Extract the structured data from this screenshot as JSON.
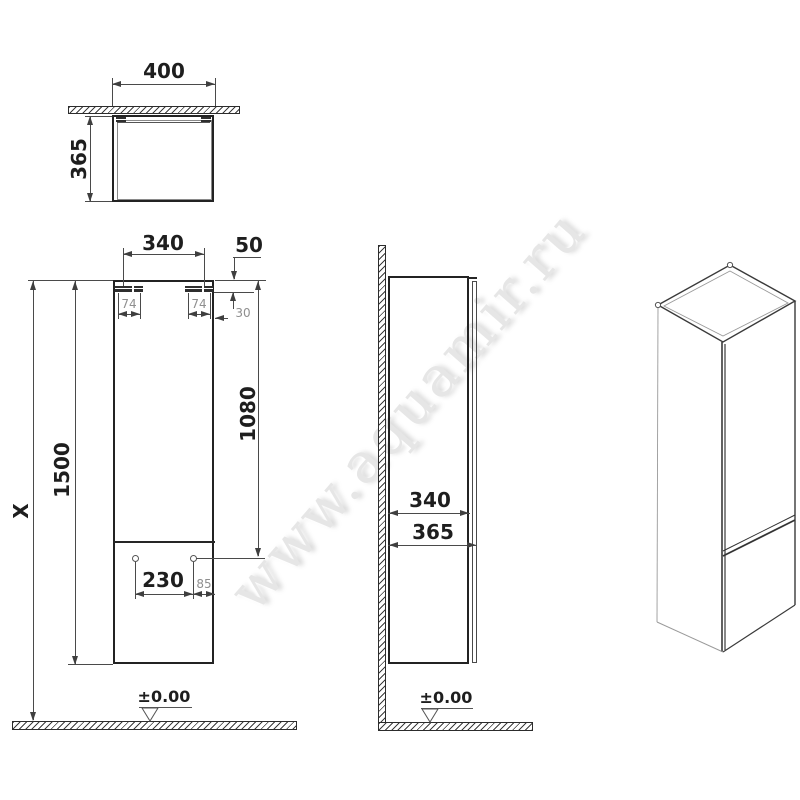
{
  "watermark": "www.aquamir.ru",
  "top_view": {
    "width": "400",
    "depth": "365"
  },
  "front_view": {
    "hanger_span": "340",
    "top_gap": "50",
    "hanger_width_left": "74",
    "hanger_width_right": "74",
    "hanger_offset": "30",
    "holes_height": "1080",
    "cabinet_height": "1500",
    "total_height": "X",
    "holes_span": "230",
    "hole_edge": "85",
    "floor_level": "±0.00"
  },
  "side_view": {
    "body_depth": "340",
    "total_depth": "365",
    "floor_level": "±0.00"
  },
  "colors": {
    "line": "#4a4a4a",
    "outline": "#232323",
    "dim_text": "#1e1e1e",
    "small_text": "#8f8f8f",
    "watermark": "#e6e6e6"
  }
}
